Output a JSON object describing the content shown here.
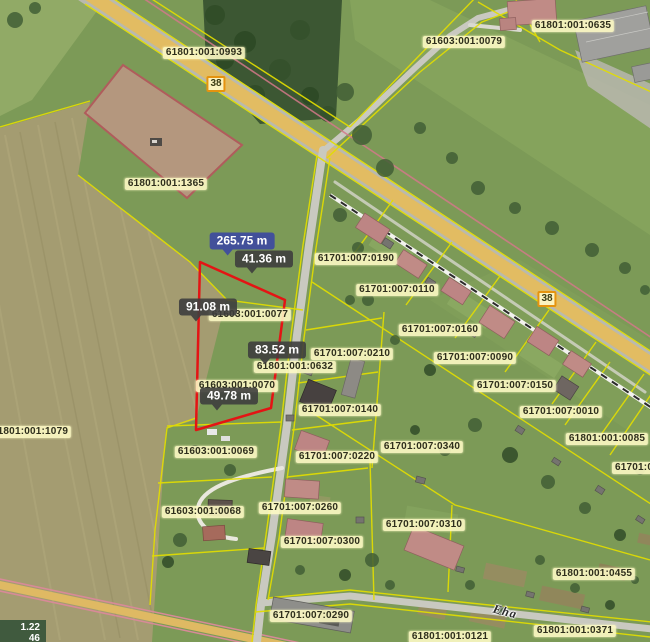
{
  "map": {
    "description": "Cadastral parcel map over aerial photo",
    "route_badge": "38",
    "street_name": "Eha",
    "coordinates_overlay": {
      "line1": "1.22",
      "line2": "46"
    },
    "measurement": {
      "total": "265.75 m",
      "segment_top": "41.36 m",
      "segment_west": "91.08 m",
      "segment_east": "83.52 m",
      "segment_south": "49.78 m"
    },
    "parcel_labels": {
      "l1": "61801:001:0993",
      "l2": "61603:001:0079",
      "l3": "61801:001:0635",
      "l4": "61801:001:1365",
      "l5": "61701:007:0190",
      "l6": "61701:007:0110",
      "l7": "61701:007:0160",
      "l8": "61701:007:0210",
      "l9": "61603:001:0077",
      "l10": "61801:001:0632",
      "l11": "61603:001:0070",
      "l12": "61701:007:0090",
      "l13": "61701:007:0150",
      "l14": "61701:007:0010",
      "l15": "61701:007:0140",
      "l16": "61701:007:0340",
      "l17": "61701:007:0220",
      "l18": "61801:001:1079",
      "l19": "61603:001:0069",
      "l20": "61801:001:0085",
      "l21": "61701:00",
      "l22": "61603:001:0068",
      "l23": "61701:007:0260",
      "l24": "61701:007:0310",
      "l25": "61701:007:0300",
      "l26": "61801:001:0455",
      "l27": "61701:007:0290",
      "l28": "61801:001:0371",
      "l29": "61801:001:0121"
    },
    "colors": {
      "cadastral_line": "#e3de00",
      "measure_outline": "#e41414",
      "highlight_parcel": "#d79696",
      "measure_total_bg": "#3f4c9e",
      "measure_bg": "#3e3e3e",
      "label_bg": "#fdf9c4",
      "route_badge_border": "#e5930f"
    }
  }
}
